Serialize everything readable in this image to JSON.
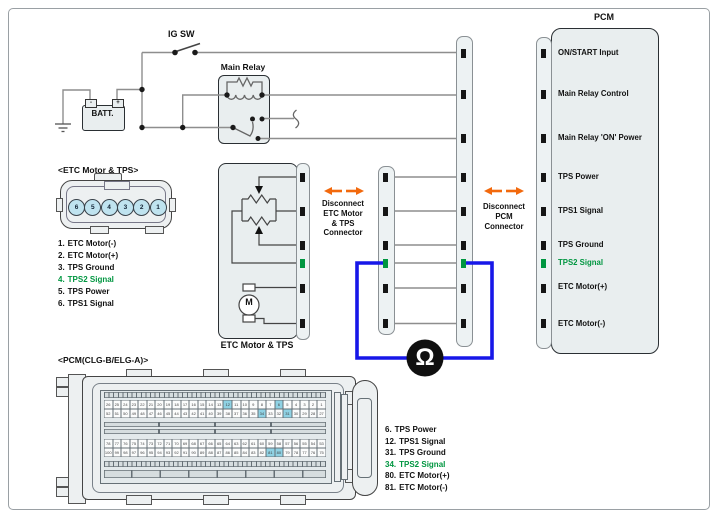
{
  "power": {
    "ig_switch": "IG SW",
    "battery": "BATT.",
    "battery_minus": "-",
    "battery_plus": "+",
    "main_relay": "Main Relay"
  },
  "etc_component": {
    "box_label": "ETC Motor & TPS",
    "motor": "M"
  },
  "etc_connector": {
    "title": "<ETC Motor & TPS>",
    "cavity_numbers": [
      "6",
      "5",
      "4",
      "3",
      "2",
      "1"
    ],
    "pins": [
      {
        "num": "1.",
        "label": "ETC Motor(-)",
        "green": false
      },
      {
        "num": "2.",
        "label": "ETC Motor(+)",
        "green": false
      },
      {
        "num": "3.",
        "label": "TPS Ground",
        "green": false
      },
      {
        "num": "4.",
        "label": "TPS2 Signal",
        "green": true
      },
      {
        "num": "5.",
        "label": "TPS Power",
        "green": false
      },
      {
        "num": "6.",
        "label": "TPS1 Signal",
        "green": false
      }
    ]
  },
  "pcm": {
    "title": "PCM",
    "rows": [
      {
        "label": "ON/START Input",
        "green": false
      },
      {
        "label": "Main Relay Control",
        "green": false
      },
      {
        "label": "Main Relay 'ON' Power",
        "green": false
      },
      {
        "label": "TPS Power",
        "green": false
      },
      {
        "label": "TPS1 Signal",
        "green": false
      },
      {
        "label": "TPS Ground",
        "green": false
      },
      {
        "label": "TPS2 Signal",
        "green": true
      },
      {
        "label": "ETC Motor(+)",
        "green": false
      },
      {
        "label": "ETC Motor(-)",
        "green": false
      }
    ]
  },
  "callouts": {
    "disconnect_etc": [
      "Disconnect",
      "ETC Motor",
      "& TPS",
      "Connector"
    ],
    "disconnect_pcm": [
      "Disconnect",
      "PCM",
      "Connector"
    ]
  },
  "meter": {
    "symbol": "Ω"
  },
  "pcm_connector": {
    "title": "<PCM(CLG-B/ELG-A)>",
    "pin_rows": [
      {
        "from": 26,
        "to": 1
      },
      {
        "from": 52,
        "to": 27
      },
      {
        "from": 78,
        "to": 53
      },
      {
        "from": 100,
        "to": 75
      }
    ],
    "highlighted_pins": [
      6,
      12,
      31,
      34,
      80,
      81
    ],
    "pins": [
      {
        "num": "6.",
        "label": "TPS Power",
        "green": false
      },
      {
        "num": "12.",
        "label": "TPS1 Signal",
        "green": false
      },
      {
        "num": "31.",
        "label": "TPS Ground",
        "green": false
      },
      {
        "num": "34.",
        "label": "TPS2 Signal",
        "green": true
      },
      {
        "num": "80.",
        "label": "ETC Motor(+)",
        "green": false
      },
      {
        "num": "81.",
        "label": "ETC Motor(-)",
        "green": false
      }
    ]
  },
  "colors": {
    "highlight_green": "#009640",
    "arrow_orange": "#F2690D",
    "meter_blue": "#1717E8",
    "pin_highlight_cyan": "#8FD2E4"
  }
}
